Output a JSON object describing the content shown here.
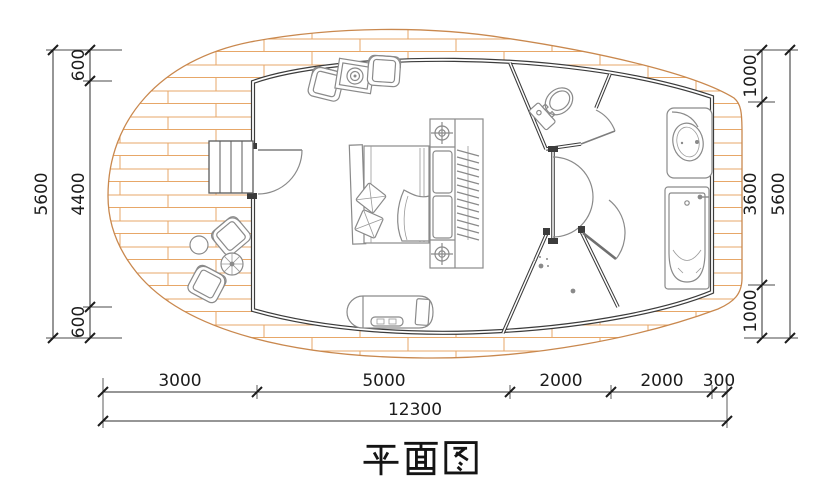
{
  "title": "平面图",
  "dimensions": {
    "left": {
      "total": "5600",
      "segments": [
        "600",
        "4400",
        "600"
      ]
    },
    "right": {
      "total": "5600",
      "segments": [
        "1000",
        "3600",
        "1000"
      ]
    },
    "bottom": {
      "total": "12300",
      "segments": [
        "3000",
        "5000",
        "2000",
        "2000",
        "300"
      ]
    }
  },
  "colors": {
    "deck_outline": "#c9884e",
    "deck_planks": "#e7a768",
    "walls": "#3c3c3c",
    "furniture": "#8a8a8a",
    "dimension_text": "#1c1c1c"
  }
}
